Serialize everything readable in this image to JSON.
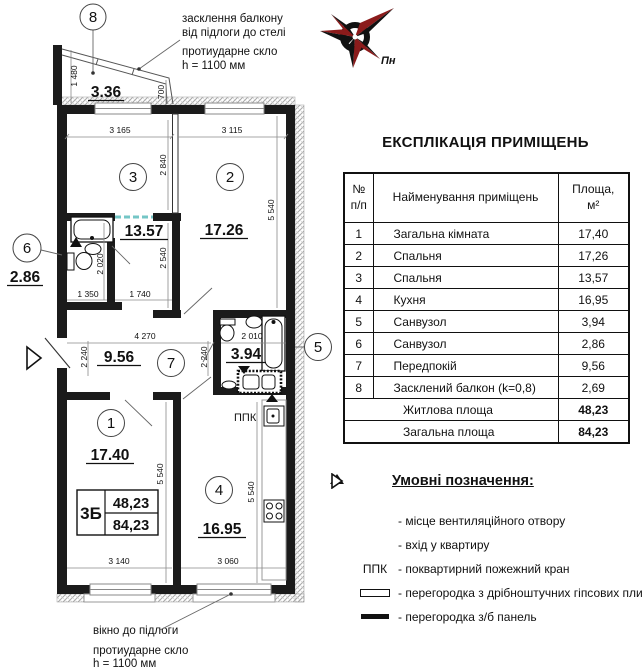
{
  "plan": {
    "balcony_note": {
      "l1": "засклення балкону",
      "l2": "від підлоги до стелі",
      "l3": "протиударне скло",
      "l4": "h = 1100 мм"
    },
    "window_note": {
      "l1": "вікно до підлоги",
      "l2": "протиударне скло",
      "l3": "h = 1100 мм"
    },
    "compass_label": "Пн",
    "circles": {
      "c1": "1",
      "c2": "2",
      "c3": "3",
      "c4": "4",
      "c5": "5",
      "c6": "6",
      "c7": "7",
      "c8": "8"
    },
    "areas": {
      "a336": "3.36",
      "a1357": "13.57",
      "a1726": "17.26",
      "a286": "2.86",
      "a956": "9.56",
      "a394": "3.94",
      "a1740": "17.40",
      "a1695": "16.95"
    },
    "stamp": {
      "type": "3Б",
      "living": "48,23",
      "total": "84,23"
    },
    "ppk": "ППК",
    "dims": {
      "d1480": "1 480",
      "d700": "700",
      "d3165": "3 165",
      "d3115": "3 115",
      "d2840": "2 840",
      "d5540a": "5 540",
      "d2020": "2 020",
      "d2540": "2 540",
      "d1350": "1 350",
      "d1740": "1 740",
      "d4270": "4 270",
      "d2240a": "2 240",
      "d2240b": "2 240",
      "d2010": "2 010",
      "d5540b": "5 540",
      "d5540c": "5 540",
      "d3140": "3 140",
      "d3060": "3 060"
    }
  },
  "table": {
    "title": "ЕКСПЛІКАЦІЯ ПРИМІЩЕНЬ",
    "headers": {
      "num1": "№",
      "num2": "п/п",
      "name": "Найменування приміщень",
      "area1": "Площа,",
      "area2": "м²"
    },
    "rows": [
      {
        "num": "1",
        "name": "Загальна кімната",
        "area": "17,40"
      },
      {
        "num": "2",
        "name": "Спальня",
        "area": "17,26"
      },
      {
        "num": "3",
        "name": "Спальня",
        "area": "13,57"
      },
      {
        "num": "4",
        "name": "Кухня",
        "area": "16,95"
      },
      {
        "num": "5",
        "name": "Санвузол",
        "area": "3,94"
      },
      {
        "num": "6",
        "name": "Санвузол",
        "area": "2,86"
      },
      {
        "num": "7",
        "name": "Передпокій",
        "area": "9,56"
      },
      {
        "num": "8",
        "name": "Засклений балкон (k=0,8)",
        "area": "2,69"
      }
    ],
    "summary": [
      {
        "name": "Житлова площа",
        "area": "48,23"
      },
      {
        "name": "Загальна площа",
        "area": "84,23"
      }
    ]
  },
  "legend": {
    "title": "Умовні позначення:",
    "ppk_symbol": "ППК",
    "items": [
      {
        "symbol": "vent-triangle",
        "text": "- місце вентиляційного отвору"
      },
      {
        "symbol": "entry-arrow",
        "text": "- вхід у квартиру"
      },
      {
        "symbol": "ppk",
        "text": "- поквартирний пожежний кран"
      },
      {
        "symbol": "gypsum-partition",
        "text": "- перегородка з дрібноштучних гіпсових плит"
      },
      {
        "symbol": "concrete-panel",
        "text": "- перегородка з/б панель"
      }
    ]
  },
  "colors": {
    "wall": "#1b1b1b",
    "compass_red": "#8b1b1b",
    "dashed_teal": "#74c6c6"
  }
}
